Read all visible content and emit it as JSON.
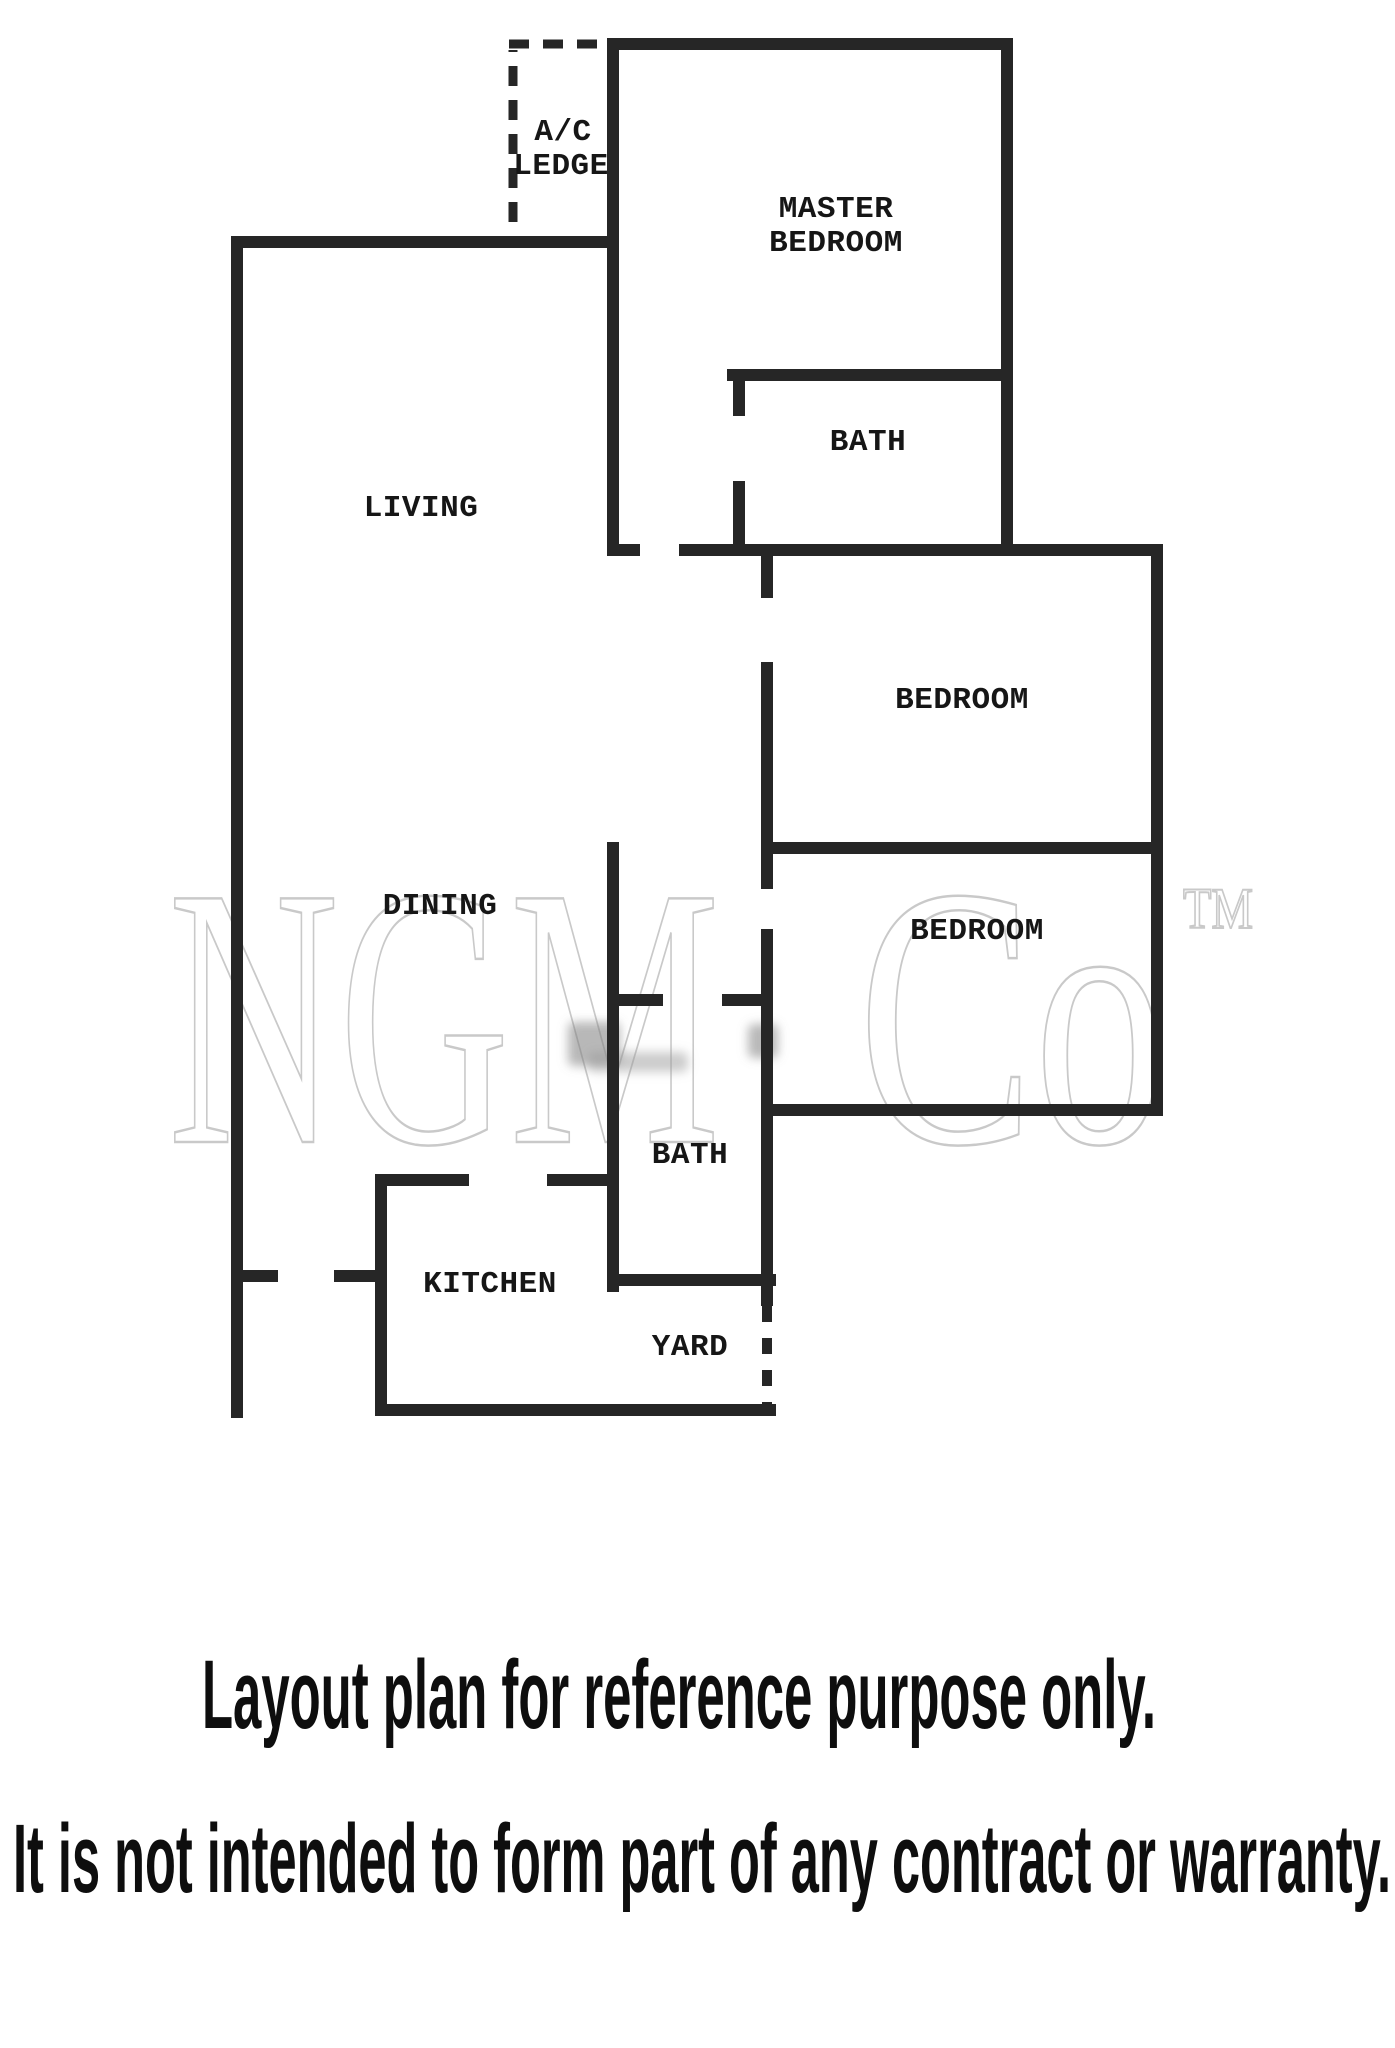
{
  "floor_plan": {
    "wall_color": "#262626",
    "label_color": "#161616",
    "rooms": {
      "ac_ledge_line1": "A/C",
      "ac_ledge_line2": "LEDGE",
      "master_bedroom_line1": "MASTER",
      "master_bedroom_line2": "BEDROOM",
      "master_bath": "BATH",
      "living": "LIVING",
      "bedroom_upper": "BEDROOM",
      "dining": "DINING",
      "bedroom_lower": "BEDROOM",
      "bath": "BATH",
      "kitchen": "KITCHEN",
      "yard": "YARD"
    }
  },
  "watermark": {
    "name": "NGM",
    "suffix": "Co",
    "tm": "TM",
    "color": "#c9c9c9"
  },
  "disclaimer": {
    "line1": "Layout plan for reference purpose only.",
    "line2": "It is not intended to form part of any contract or warranty.",
    "color": "#0e0e0e"
  }
}
